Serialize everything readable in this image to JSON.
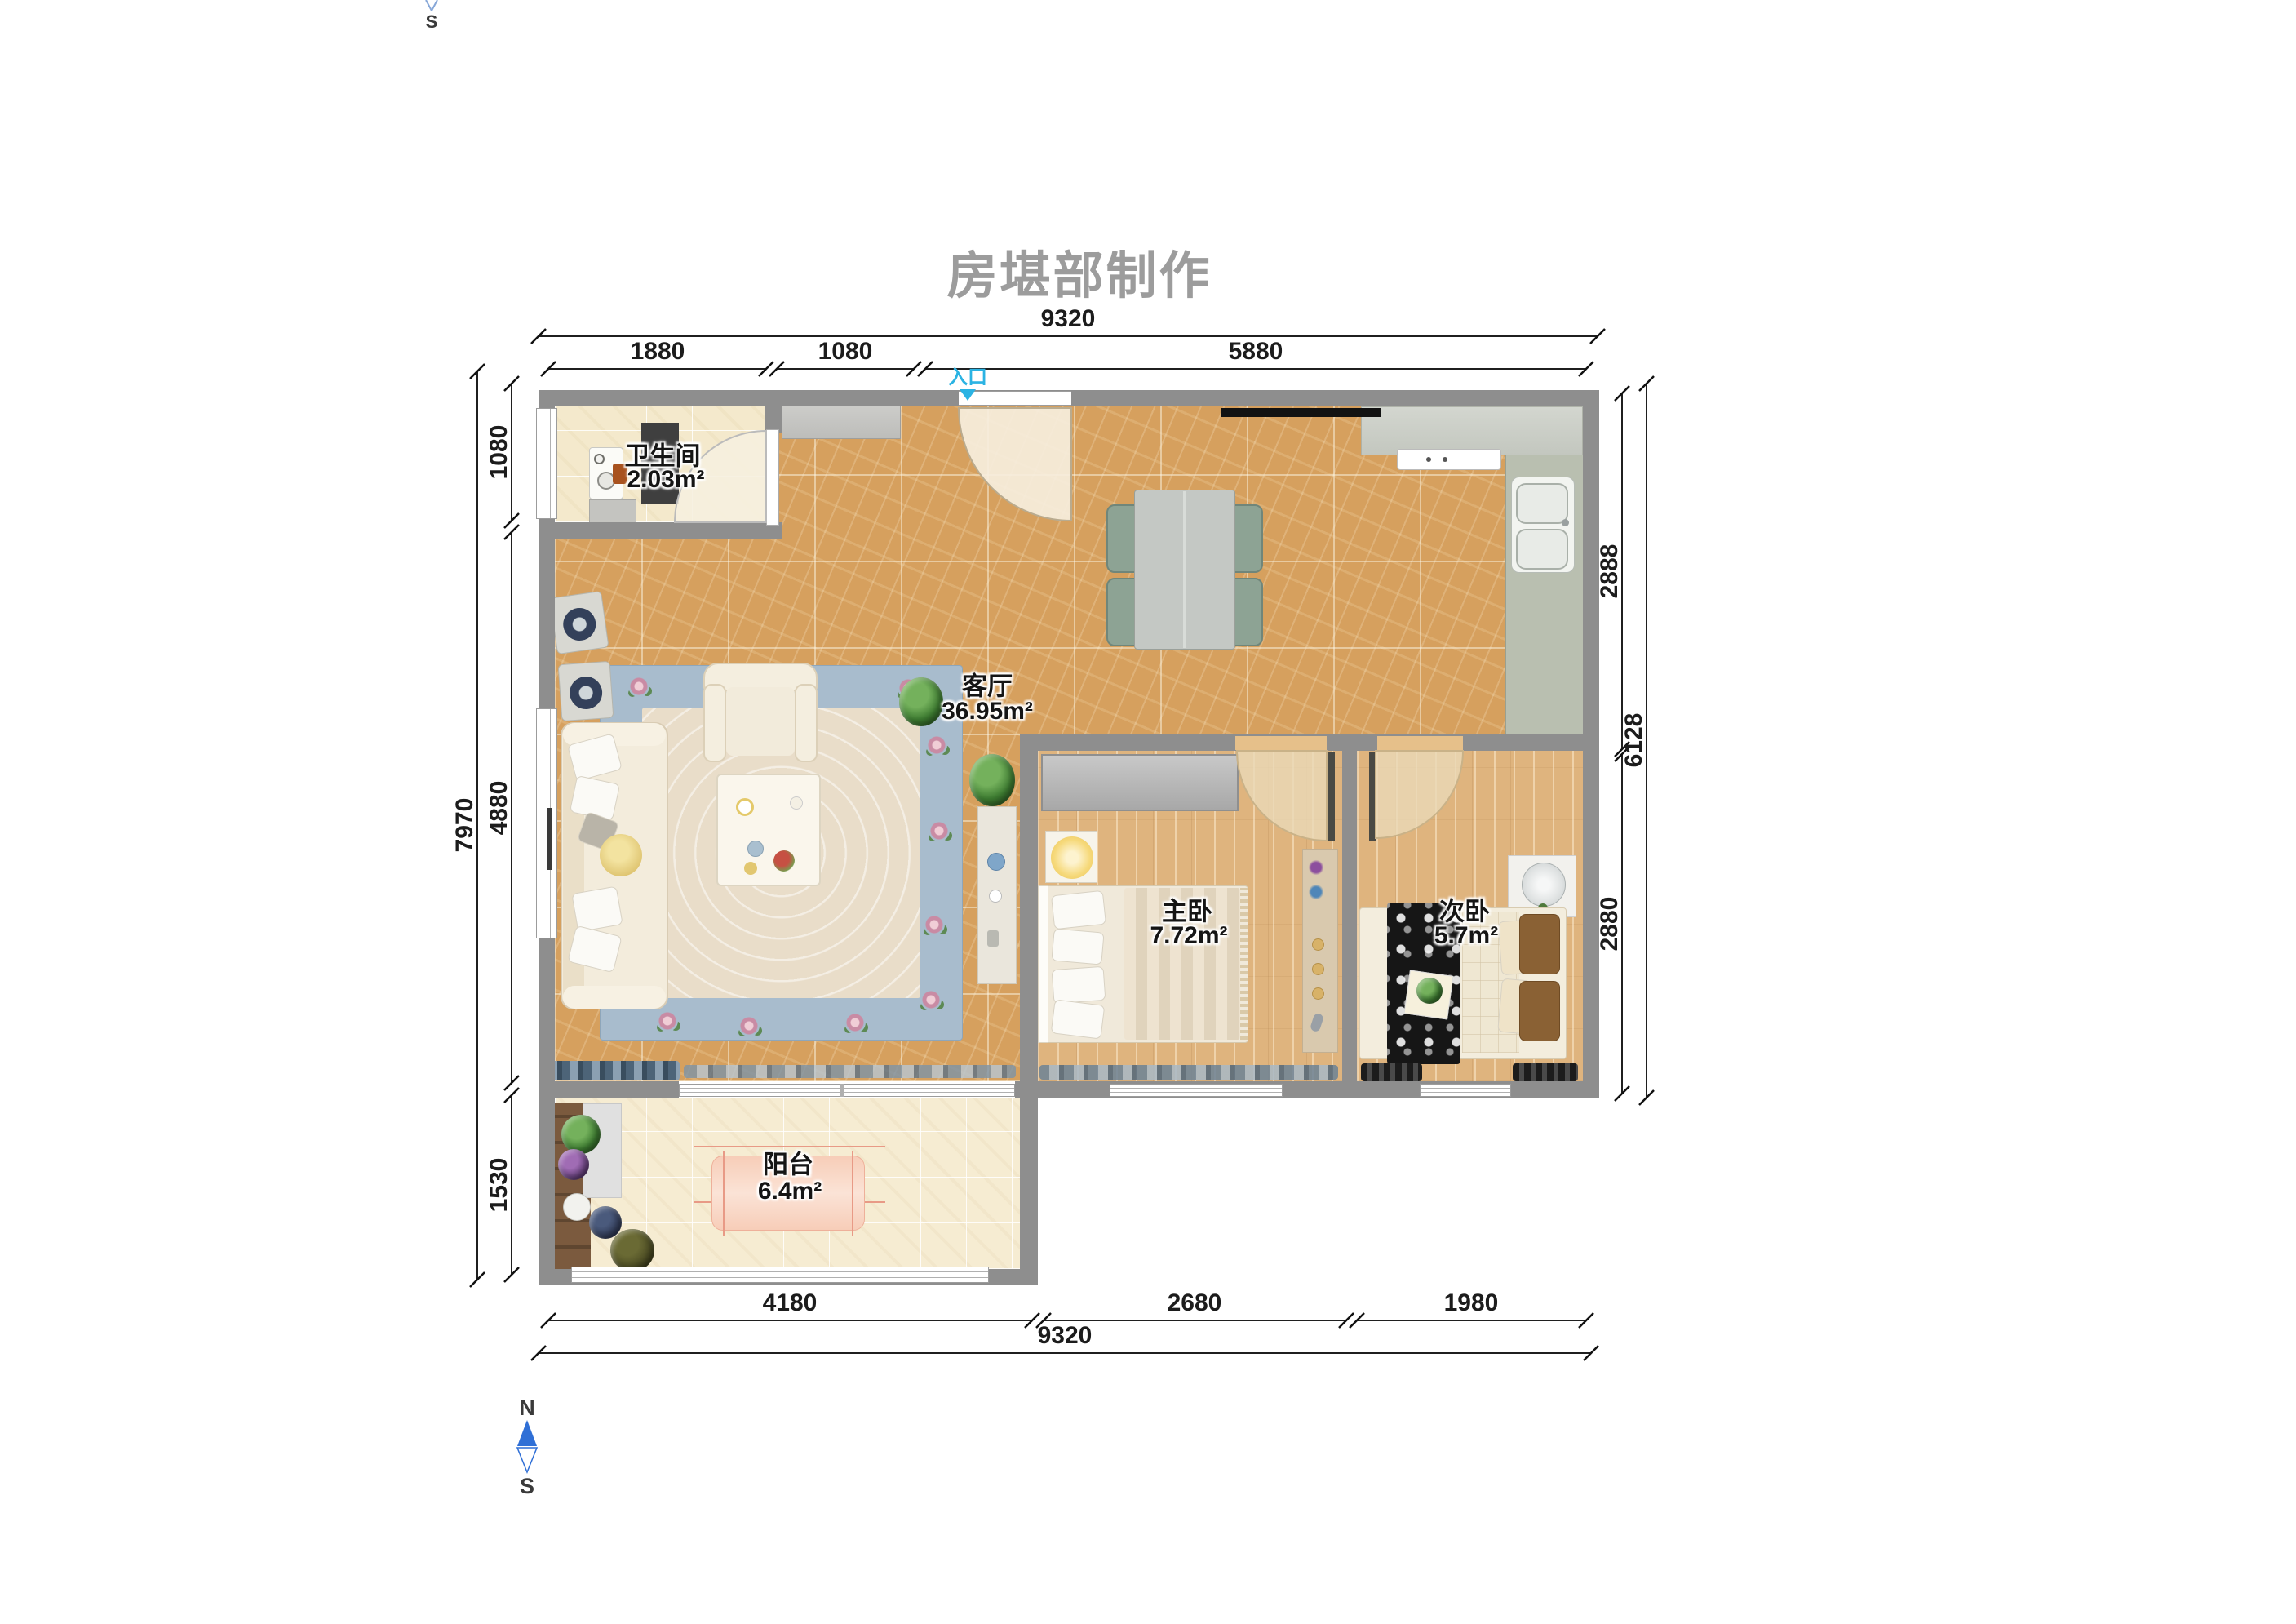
{
  "title": "房堪部制作",
  "entrance": {
    "label": "入口"
  },
  "compass": {
    "north": "N",
    "south": "S",
    "top_partial_south": "S"
  },
  "rooms": {
    "bathroom": {
      "name": "卫生间",
      "area": "2.03m²"
    },
    "living": {
      "name": "客厅",
      "area": "36.95m²"
    },
    "master": {
      "name": "主卧",
      "area": "7.72m²"
    },
    "second": {
      "name": "次卧",
      "area": "5.7m²"
    },
    "balcony": {
      "name": "阳台",
      "area": "6.4m²"
    }
  },
  "dims": {
    "top": {
      "overall": "9320",
      "seg1": "1880",
      "seg2": "1080",
      "seg3": "5880"
    },
    "bottom": {
      "seg1": "4180",
      "seg2": "2680",
      "seg3": "1980",
      "overall": "9320"
    },
    "left": {
      "seg1": "1080",
      "seg2": "4880",
      "seg3": "1530",
      "overall": "7970"
    },
    "right": {
      "seg1": "2888",
      "seg2": "2880",
      "overall": "6128"
    }
  },
  "colors": {
    "wall": "#8e8e8e",
    "entrance_accent": "#2bb3e3",
    "compass_north": "#2f6fd6",
    "floor_living_marble": "#d6a05e",
    "floor_wood": "#dfb47e",
    "floor_tile_cream": "#f4e9cc",
    "title_gray": "#9c9c9c"
  }
}
